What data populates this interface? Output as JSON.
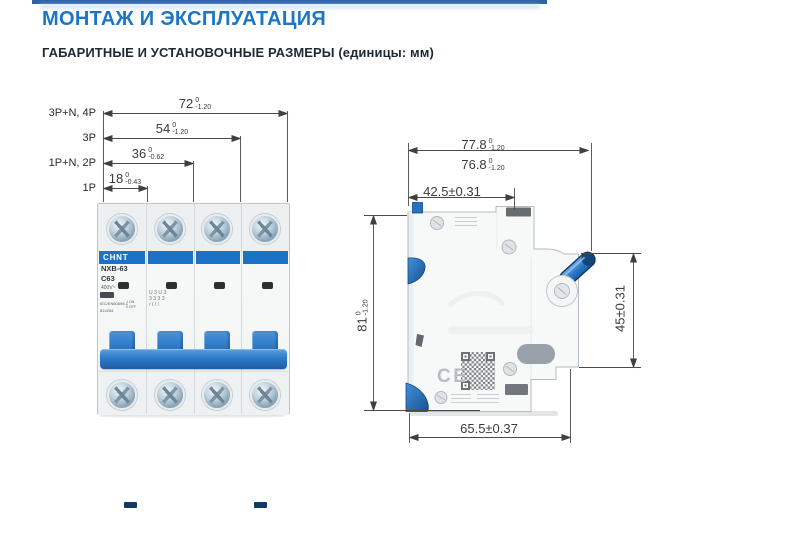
{
  "header": {
    "title": "МОНТАЖ И ЭКСПЛУАТАЦИЯ",
    "subtitle": "ГАБАРИТНЫЕ И УСТАНОВОЧНЫЕ РАЗМЕРЫ (единицы: мм)"
  },
  "front_view": {
    "pole_labels": [
      "3P+N, 4P",
      "3P",
      "1P+N, 2P",
      "1P"
    ],
    "dims": [
      {
        "value": "72",
        "tol_upper": "0",
        "tol_lower": "-1.20"
      },
      {
        "value": "54",
        "tol_upper": "0",
        "tol_lower": "-1.20"
      },
      {
        "value": "36",
        "tol_upper": "0",
        "tol_lower": "-0.62"
      },
      {
        "value": "18",
        "tol_upper": "0",
        "tol_lower": "-0.43"
      }
    ],
    "breaker": {
      "brand": "CHNT",
      "model": "NXB-63",
      "rating": "C63",
      "voltage": "400V~",
      "standard": "IEC/EN60898-1",
      "article": "814254",
      "on_label": "I ON",
      "off_label": "0 OFF",
      "module2_marks": [
        "U3U3",
        "3333",
        "////"
      ]
    }
  },
  "side_view": {
    "dims": {
      "overall_depth": {
        "value": "77.8",
        "tol_upper": "0",
        "tol_lower": "-1.20"
      },
      "body_depth": {
        "value": "76.8",
        "tol_upper": "0",
        "tol_lower": "-1.20"
      },
      "rail_depth": "42.5±0.31",
      "height": {
        "value": "81",
        "tol_upper": "0",
        "tol_lower": "-1.20"
      },
      "front_height": "45±0.31",
      "base_depth": "65.5±0.37"
    },
    "ce_mark": "CE"
  },
  "colors": {
    "accent_blue": "#1b76c5",
    "breaker_blue": "#2a7cc9",
    "subtitle_dark": "#1e2936"
  }
}
